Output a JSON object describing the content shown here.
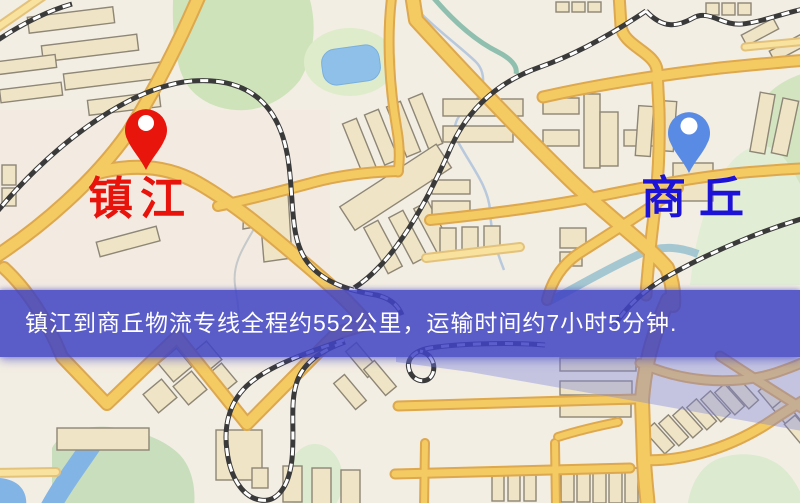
{
  "banner": {
    "text": "镇江到商丘物流专线全程约552公里，运输时间约7小时5分钟.",
    "background": "#4044c4",
    "text_color": "#ffffff"
  },
  "markers": {
    "origin": {
      "name": "镇江",
      "pin_color": "#e8150c",
      "label_color": "#e8140c"
    },
    "destination": {
      "name": "商丘",
      "pin_color": "#5a8be4",
      "label_color": "#1c13d6"
    }
  },
  "map_colors": {
    "background": "#f3eee3",
    "road_major_fill": "#f4ca63",
    "road_major_casing": "#dda84e",
    "road_minor_fill": "#f8e29e",
    "road_minor_casing": "#e3c27c",
    "park": "#cfe3ba",
    "water": "#8fc0ea",
    "building_fill": "#efe5c6",
    "building_stroke": "#8e8676",
    "railway_dark": "#3a3a3a",
    "overlay_wash": "#7a82e0"
  }
}
